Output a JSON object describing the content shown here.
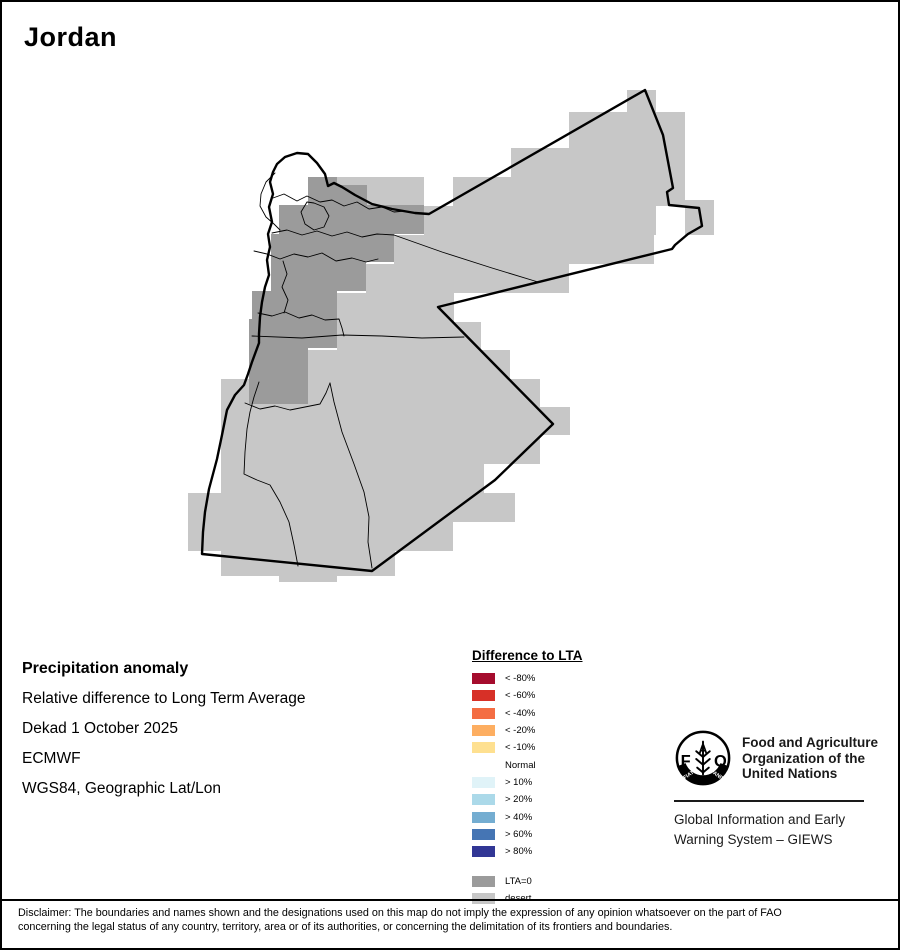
{
  "window": {
    "title": "Jordan"
  },
  "map": {
    "palette": {
      "desert": "#C7C7C7",
      "lta_zero": "#9B9B9B",
      "border": "#000000",
      "background": "#FFFFFF"
    }
  },
  "info_block": {
    "heading": "Precipitation anomaly",
    "lines": [
      "Relative difference to Long Term Average",
      "Dekad 1 October 2025",
      "ECMWF",
      "WGS84, Geographic Lat/Lon"
    ]
  },
  "legend": {
    "title": "Difference to LTA",
    "entries": [
      {
        "label": "< -80%",
        "color": "#A50C2D"
      },
      {
        "label": "< -60%",
        "color": "#D73027"
      },
      {
        "label": "< -40%",
        "color": "#F46D43"
      },
      {
        "label": "< -20%",
        "color": "#FDAE61"
      },
      {
        "label": "< -10%",
        "color": "#FEE090"
      },
      {
        "label": "Normal",
        "color": null
      },
      {
        "label": "> 10%",
        "color": "#E0F3F8"
      },
      {
        "label": "> 20%",
        "color": "#ABD9E9"
      },
      {
        "label": "> 40%",
        "color": "#74ADD1"
      },
      {
        "label": "> 60%",
        "color": "#4575B4"
      },
      {
        "label": "> 80%",
        "color": "#313695"
      }
    ],
    "special_entries": [
      {
        "label": "LTA=0",
        "color": "#9B9B9B"
      },
      {
        "label": "desert",
        "color": "#C7C7C7"
      }
    ]
  },
  "fao": {
    "logo_text": "FAO",
    "motto_left": "FIAT",
    "motto_right": "PANIS",
    "org_name_lines": [
      "Food and Agriculture",
      "Organization of the",
      "United Nations"
    ],
    "giews_lines": [
      "Global Information and Early",
      "Warning System – GIEWS"
    ]
  },
  "disclaimer": {
    "line1": "Disclaimer: The boundaries and names shown and the designations used on this map do not imply the expression of any opinion whatsoever on the part of FAO",
    "line2": "concerning the legal status of any country, territory, area or of its authorities, or concerning the delimitation of its frontiers and boundaries."
  }
}
